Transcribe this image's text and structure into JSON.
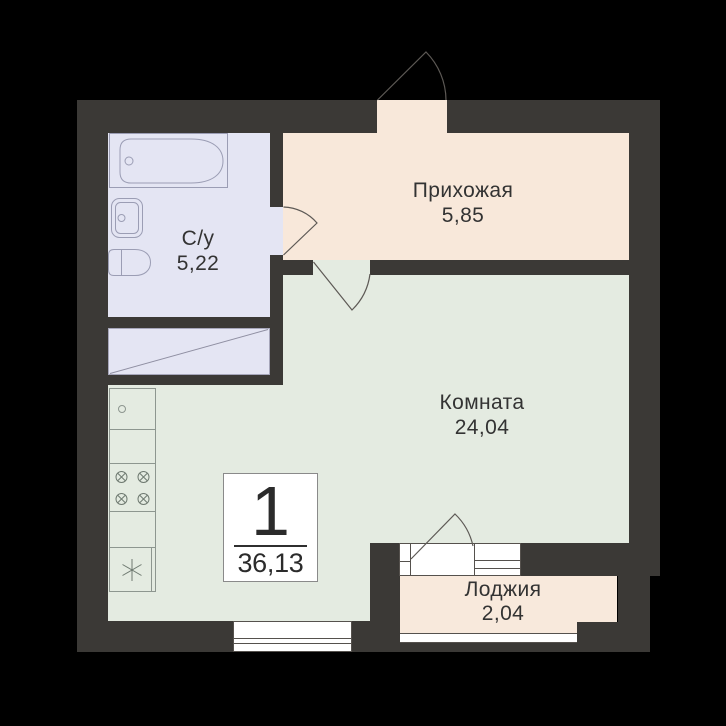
{
  "plan": {
    "badge": {
      "rooms_count": "1",
      "total_area": "36,13"
    },
    "rooms": [
      {
        "id": "hallway",
        "name": "Прихожая",
        "area": "5,85",
        "floor_color": "#f8e8da"
      },
      {
        "id": "bathroom",
        "name": "С/у",
        "area": "5,22",
        "floor_color": "#e4e5f3"
      },
      {
        "id": "living-room",
        "name": "Комната",
        "area": "24,04",
        "floor_color": "#e4ebe1"
      },
      {
        "id": "loggia",
        "name": "Лоджия",
        "area": "2,04",
        "floor_color": "#f8e9dc"
      }
    ],
    "colors": {
      "background": "#000000",
      "wall": "#3b3936",
      "fixture_line": "#9b9db4",
      "kitchen_line": "#8d968f",
      "door_arc": "#5d5955",
      "frame_line": "#55514d",
      "badge_border": "#8a8a8a",
      "text": "#333333"
    }
  }
}
